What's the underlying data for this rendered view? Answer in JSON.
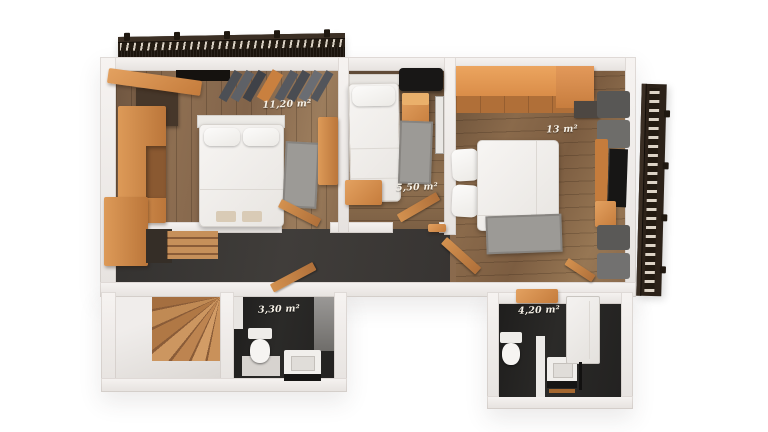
{
  "scene": {
    "type": "3d-floor-plan-top-view-render",
    "background": "#ffffff"
  },
  "rooms": [
    {
      "name": "bedroom-left",
      "area_label": "11,20 m²",
      "furniture": [
        "double-bed",
        "wardrobe",
        "dark-cabinet",
        "clothes-rack",
        "rug",
        "bench",
        "open-door"
      ]
    },
    {
      "name": "small-room-middle",
      "area_label": "5,50 m²",
      "furniture": [
        "single-bed",
        "wall-shelf",
        "nightstand",
        "mirror",
        "rug",
        "cabinet",
        "open-door"
      ]
    },
    {
      "name": "bedroom-right",
      "area_label": "13 m²",
      "furniture": [
        "double-bed",
        "wardrobe",
        "gray-cabinet",
        "lounge-seats",
        "desk",
        "tv-panel",
        "low-table",
        "rug",
        "open-door"
      ]
    },
    {
      "name": "bathroom-left",
      "area_label": "3,30 m²",
      "furniture": [
        "toilet",
        "sink-vanity",
        "open-door"
      ]
    },
    {
      "name": "bathroom-right",
      "area_label": "4,20 m²",
      "furniture": [
        "toilet",
        "sink-vanity",
        "shower-column",
        "open-door"
      ]
    }
  ],
  "other_elements": [
    "balcony-railing-top",
    "balcony-railing-right",
    "staircase-winder",
    "hallway"
  ],
  "colors": {
    "wall": "#efecea",
    "wood_floor": "#8a6c4f",
    "hall_floor": "#3b3835",
    "bath_floor": "#242322",
    "furniture_orange": "#d28c4c",
    "railing_brown": "#2c2219",
    "bed_white": "#f3f1ee",
    "rug_gray": "#9c9a96",
    "label_text": "#f6f1e7"
  }
}
